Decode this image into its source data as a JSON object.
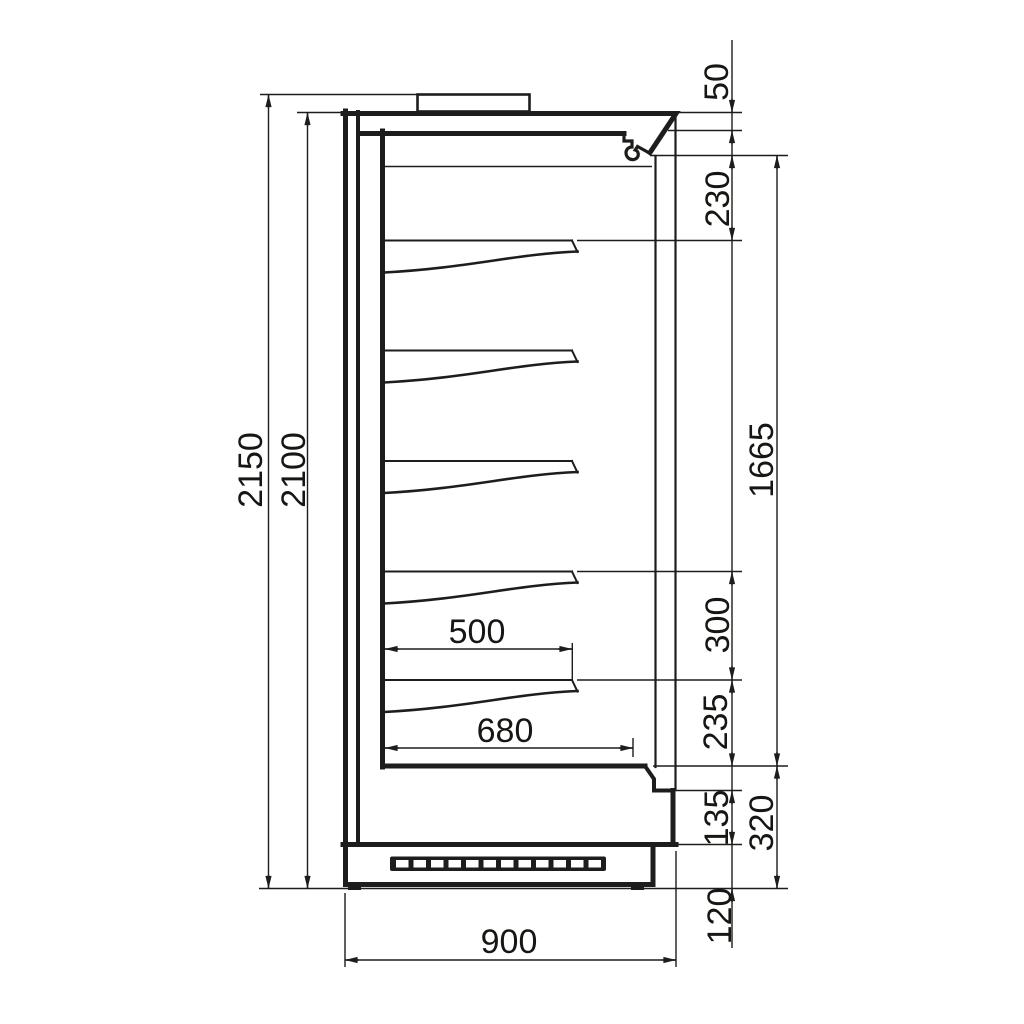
{
  "meta": {
    "background": "#ffffff",
    "line_color": "#1d1d1b",
    "unit": "mm",
    "view": "side section technical drawing"
  },
  "dims": {
    "d2150": "2150",
    "d2100": "2100",
    "d50": "50",
    "d230": "230",
    "d1665": "1665",
    "d300": "300",
    "d235": "235",
    "d135": "135",
    "d320": "320",
    "d120": "120",
    "d500": "500",
    "d680": "680",
    "d900": "900"
  }
}
